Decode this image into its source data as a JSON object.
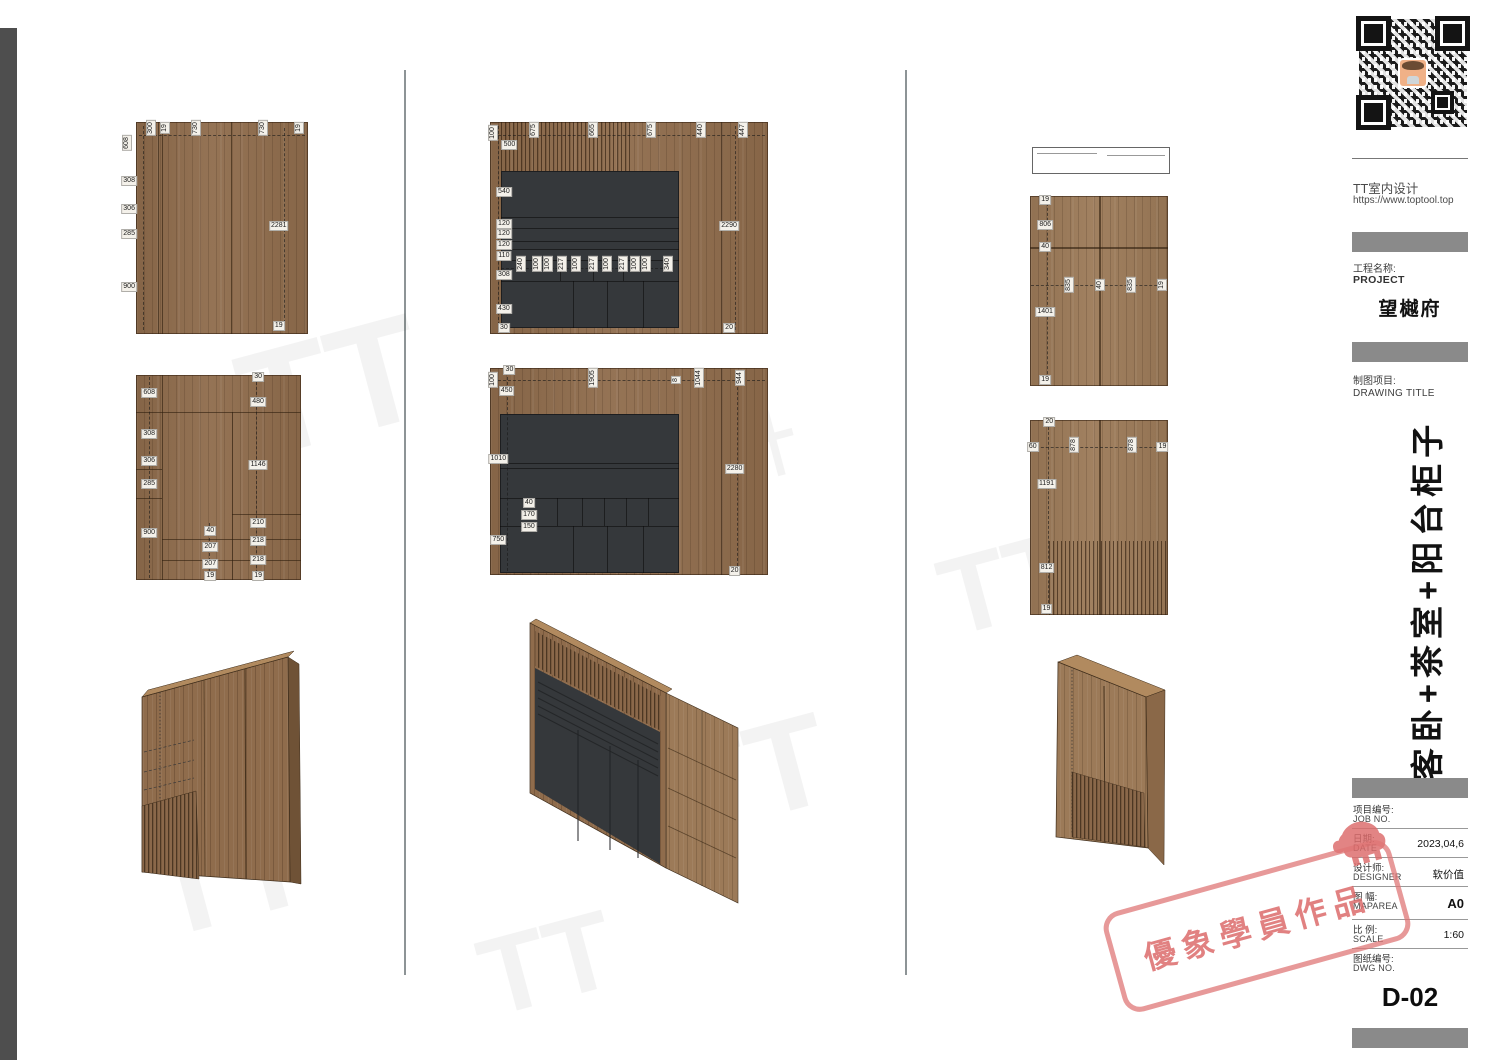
{
  "titleblock": {
    "company": "TT室内设计",
    "website": "https://www.toptool.top",
    "project_label_zh": "工程名称:",
    "project_label_en": "PROJECT",
    "project_name": "望樾府",
    "drawing_label_zh": "制图项目:",
    "drawing_label_en": "DRAWING TITLE",
    "drawing_title_vertical": "客卧+茶室+阳台柜子",
    "rows": [
      {
        "zh": "项目编号:",
        "en": "JOB NO.",
        "value": ""
      },
      {
        "zh": "日期:",
        "en": "DATE",
        "value": "2023,04,6"
      },
      {
        "zh": "设计师:",
        "en": "DESIGNER",
        "value": "软价值"
      },
      {
        "zh": "图 幅:",
        "en": "MAPAREA",
        "value": "A0"
      },
      {
        "zh": "比 例:",
        "en": "SCALE",
        "value": "1:60"
      },
      {
        "zh": "图纸编号:",
        "en": "DWG NO.",
        "value": ""
      }
    ],
    "sheet_no": "D-02"
  },
  "stamp": {
    "text": "優象學員作品",
    "color": "#df7474"
  },
  "watermark": {
    "brand_short": "TT",
    "brand_cn": "室内设计"
  },
  "drawings": {
    "elev_a": {
      "dims": [
        {
          "t": "608",
          "x": -5,
          "y": 10,
          "r": 1
        },
        {
          "t": "300",
          "x": 9,
          "y": 3,
          "r": 1
        },
        {
          "t": "19",
          "x": 17,
          "y": 3,
          "r": 1
        },
        {
          "t": "730",
          "x": 35,
          "y": 3,
          "r": 1
        },
        {
          "t": "730",
          "x": 74,
          "y": 3,
          "r": 1
        },
        {
          "t": "19",
          "x": 95,
          "y": 3,
          "r": 1
        },
        {
          "t": "308",
          "x": -4,
          "y": 28
        },
        {
          "t": "306",
          "x": -4,
          "y": 41
        },
        {
          "t": "285",
          "x": -4,
          "y": 53
        },
        {
          "t": "900",
          "x": -4,
          "y": 78
        },
        {
          "t": "2281",
          "x": 83,
          "y": 49
        },
        {
          "t": "19",
          "x": 83,
          "y": 96
        }
      ]
    },
    "elev_b": {
      "dims": [
        {
          "t": "608",
          "x": 8,
          "y": 9
        },
        {
          "t": "308",
          "x": 8,
          "y": 29
        },
        {
          "t": "306",
          "x": 8,
          "y": 42
        },
        {
          "t": "285",
          "x": 8,
          "y": 53
        },
        {
          "t": "900",
          "x": 8,
          "y": 77
        },
        {
          "t": "30",
          "x": 74,
          "y": 1
        },
        {
          "t": "480",
          "x": 74,
          "y": 13
        },
        {
          "t": "1146",
          "x": 74,
          "y": 44
        },
        {
          "t": "210",
          "x": 74,
          "y": 72
        },
        {
          "t": "218",
          "x": 74,
          "y": 81
        },
        {
          "t": "218",
          "x": 74,
          "y": 90
        },
        {
          "t": "40",
          "x": 45,
          "y": 76
        },
        {
          "t": "207",
          "x": 45,
          "y": 84
        },
        {
          "t": "207",
          "x": 45,
          "y": 92
        },
        {
          "t": "19",
          "x": 45,
          "y": 98
        },
        {
          "t": "19",
          "x": 74,
          "y": 98
        }
      ]
    },
    "elev_c": {
      "dims": [
        {
          "t": "100",
          "x": 1,
          "y": 5,
          "r": 1
        },
        {
          "t": "500",
          "x": 7,
          "y": 11
        },
        {
          "t": "675",
          "x": 16,
          "y": 4,
          "r": 1
        },
        {
          "t": "665",
          "x": 37,
          "y": 4,
          "r": 1
        },
        {
          "t": "675",
          "x": 58,
          "y": 4,
          "r": 1
        },
        {
          "t": "440",
          "x": 76,
          "y": 4,
          "r": 1
        },
        {
          "t": "447",
          "x": 91,
          "y": 4,
          "r": 1
        },
        {
          "t": "540",
          "x": 5,
          "y": 33
        },
        {
          "t": "120",
          "x": 5,
          "y": 48
        },
        {
          "t": "120",
          "x": 5,
          "y": 53
        },
        {
          "t": "120",
          "x": 5,
          "y": 58
        },
        {
          "t": "110",
          "x": 5,
          "y": 63
        },
        {
          "t": "240",
          "x": 11,
          "y": 67,
          "r": 1
        },
        {
          "t": "100",
          "x": 17,
          "y": 67,
          "r": 1
        },
        {
          "t": "100",
          "x": 21,
          "y": 67,
          "r": 1
        },
        {
          "t": "217",
          "x": 26,
          "y": 67,
          "r": 1
        },
        {
          "t": "100",
          "x": 31,
          "y": 67,
          "r": 1
        },
        {
          "t": "217",
          "x": 37,
          "y": 67,
          "r": 1
        },
        {
          "t": "100",
          "x": 42,
          "y": 67,
          "r": 1
        },
        {
          "t": "217",
          "x": 48,
          "y": 67,
          "r": 1
        },
        {
          "t": "100",
          "x": 52,
          "y": 67,
          "r": 1
        },
        {
          "t": "100",
          "x": 56,
          "y": 67,
          "r": 1
        },
        {
          "t": "340",
          "x": 64,
          "y": 67,
          "r": 1
        },
        {
          "t": "308",
          "x": 5,
          "y": 72
        },
        {
          "t": "430",
          "x": 5,
          "y": 88
        },
        {
          "t": "30",
          "x": 5,
          "y": 97
        },
        {
          "t": "2290",
          "x": 86,
          "y": 49
        },
        {
          "t": "20",
          "x": 86,
          "y": 97
        }
      ]
    },
    "elev_d": {
      "dims": [
        {
          "t": "30",
          "x": 7,
          "y": 1
        },
        {
          "t": "100",
          "x": 1,
          "y": 6,
          "r": 1
        },
        {
          "t": "450",
          "x": 6,
          "y": 11
        },
        {
          "t": "1905",
          "x": 37,
          "y": 5,
          "r": 1
        },
        {
          "t": "8",
          "x": 67,
          "y": 6,
          "r": 1
        },
        {
          "t": "1044",
          "x": 75,
          "y": 5,
          "r": 1
        },
        {
          "t": "944",
          "x": 90,
          "y": 5,
          "r": 1
        },
        {
          "t": "1010",
          "x": 3,
          "y": 44
        },
        {
          "t": "40",
          "x": 14,
          "y": 65
        },
        {
          "t": "170",
          "x": 14,
          "y": 71
        },
        {
          "t": "150",
          "x": 14,
          "y": 77
        },
        {
          "t": "750",
          "x": 3,
          "y": 83
        },
        {
          "t": "2280",
          "x": 88,
          "y": 49
        },
        {
          "t": "20",
          "x": 88,
          "y": 98
        }
      ]
    },
    "elev_e": {
      "dims": [
        {
          "t": "19",
          "x": 11,
          "y": 2
        },
        {
          "t": "806",
          "x": 11,
          "y": 15
        },
        {
          "t": "40",
          "x": 11,
          "y": 27
        },
        {
          "t": "835",
          "x": 28,
          "y": 47,
          "r": 1
        },
        {
          "t": "40",
          "x": 51,
          "y": 47,
          "r": 1
        },
        {
          "t": "835",
          "x": 73,
          "y": 47,
          "r": 1
        },
        {
          "t": "19",
          "x": 96,
          "y": 47,
          "r": 1
        },
        {
          "t": "1401",
          "x": 11,
          "y": 61
        },
        {
          "t": "19",
          "x": 11,
          "y": 97
        }
      ]
    },
    "elev_f": {
      "dims": [
        {
          "t": "20",
          "x": 14,
          "y": 1
        },
        {
          "t": "60",
          "x": 2,
          "y": 14
        },
        {
          "t": "878",
          "x": 32,
          "y": 13,
          "r": 1
        },
        {
          "t": "878",
          "x": 74,
          "y": 13,
          "r": 1
        },
        {
          "t": "19",
          "x": 96,
          "y": 14
        },
        {
          "t": "1191",
          "x": 12,
          "y": 33
        },
        {
          "t": "812",
          "x": 12,
          "y": 76
        },
        {
          "t": "19",
          "x": 12,
          "y": 97
        }
      ]
    }
  }
}
